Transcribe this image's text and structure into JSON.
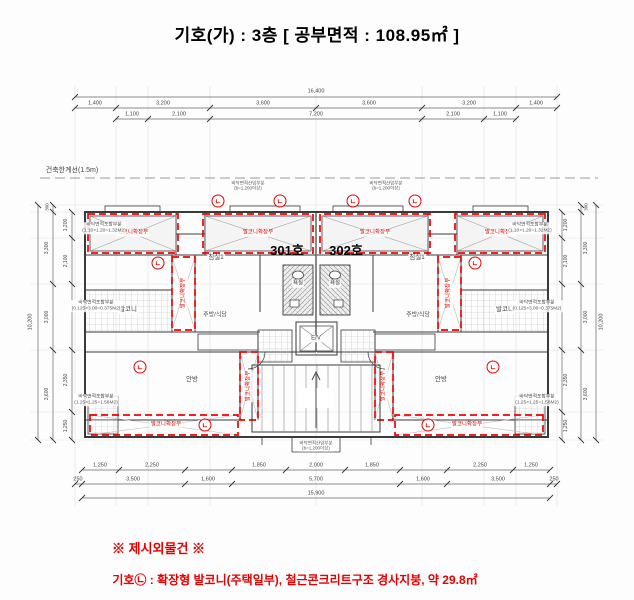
{
  "title": "기호(가) : 3층 [ 공부면적 : 108.95㎡ ]",
  "footer": {
    "heading": "※ 제시외물건 ※",
    "note": "기호㉡ : 확장형 발코니(주택일부), 철근콘크리트구조 경사지붕, 약 29.8㎡"
  },
  "colors": {
    "red": "#e60000",
    "wall": "#3a3a3a",
    "dim": "#444444",
    "grid": "#d4d4d4"
  },
  "plan": {
    "setback_label": "건축한계선(1.5m)",
    "mark_char": "ㄴ",
    "marks": [
      {
        "x": 218,
        "y": 201
      },
      {
        "x": 280,
        "y": 201
      },
      {
        "x": 353,
        "y": 201
      },
      {
        "x": 415,
        "y": 201
      },
      {
        "x": 158,
        "y": 263
      },
      {
        "x": 475,
        "y": 263
      },
      {
        "x": 140,
        "y": 367
      },
      {
        "x": 493,
        "y": 367
      },
      {
        "x": 205,
        "y": 425
      },
      {
        "x": 428,
        "y": 425
      }
    ],
    "texts": [
      {
        "n": "setback-line-label",
        "t": "건축한계선(1.5m)",
        "x": 72,
        "y": 171,
        "s": 7,
        "c": "#444"
      },
      {
        "n": "unit-301-label",
        "t": "301호",
        "x": 287,
        "y": 251,
        "s": 13,
        "b": 1,
        "c": "#000"
      },
      {
        "n": "unit-302-label",
        "t": "302호",
        "x": 346,
        "y": 251,
        "s": 13,
        "b": 1,
        "c": "#000"
      },
      {
        "n": "room-bedroom1-301",
        "t": "침실1",
        "x": 216,
        "y": 258,
        "s": 6.5,
        "bg": 1
      },
      {
        "n": "room-bedroom1-302",
        "t": "침실1",
        "x": 417,
        "y": 258,
        "s": 6.5,
        "bg": 1
      },
      {
        "n": "room-balcony-301",
        "t": "발코니",
        "x": 128,
        "y": 310,
        "s": 6.5,
        "bg": 1
      },
      {
        "n": "room-balcony-302",
        "t": "발코니",
        "x": 505,
        "y": 310,
        "s": 6.5,
        "bg": 1
      },
      {
        "n": "room-kitchen-301",
        "t": "주방/식당",
        "x": 215,
        "y": 316,
        "s": 6,
        "bg": 1
      },
      {
        "n": "room-kitchen-302",
        "t": "주방/식당",
        "x": 418,
        "y": 316,
        "s": 6,
        "bg": 1
      },
      {
        "n": "room-master-301",
        "t": "안방",
        "x": 192,
        "y": 380,
        "s": 6.5,
        "bg": 1
      },
      {
        "n": "room-master-302",
        "t": "안방",
        "x": 441,
        "y": 380,
        "s": 6.5,
        "bg": 1
      },
      {
        "n": "room-bath-301",
        "t": "욕실",
        "x": 298,
        "y": 284,
        "s": 5.5,
        "bg": 1
      },
      {
        "n": "room-bath-302",
        "t": "욕실",
        "x": 335,
        "y": 284,
        "s": 5.5,
        "bg": 1
      },
      {
        "n": "elevator-label",
        "t": "E/V",
        "x": 316,
        "y": 339,
        "s": 6,
        "bg": 1
      },
      {
        "n": "balcony-ext-label",
        "t": "발코니확장부",
        "x": 133,
        "y": 233,
        "s": 5.5,
        "c": "#e60000",
        "bg": 1
      },
      {
        "n": "balcony-ext-label",
        "t": "발코니확장부",
        "x": 258,
        "y": 233,
        "s": 5.5,
        "c": "#e60000",
        "bg": 1
      },
      {
        "n": "balcony-ext-label",
        "t": "발코니확장부",
        "x": 375,
        "y": 233,
        "s": 5.5,
        "c": "#e60000",
        "bg": 1
      },
      {
        "n": "balcony-ext-label",
        "t": "발코니확장부",
        "x": 500,
        "y": 233,
        "s": 5.5,
        "c": "#e60000",
        "bg": 1
      },
      {
        "n": "balcony-ext-label",
        "t": "발코니확장부",
        "x": 184,
        "y": 293,
        "s": 5.5,
        "c": "#e60000",
        "r": -90,
        "bg": 1
      },
      {
        "n": "balcony-ext-label",
        "t": "발코니확장부",
        "x": 449,
        "y": 293,
        "s": 5.5,
        "c": "#e60000",
        "r": -90,
        "bg": 1
      },
      {
        "n": "balcony-ext-label",
        "t": "발코니확장부",
        "x": 249,
        "y": 386,
        "s": 5.5,
        "c": "#e60000",
        "r": -90,
        "bg": 1
      },
      {
        "n": "balcony-ext-label",
        "t": "발코니확장부",
        "x": 384,
        "y": 386,
        "s": 5.5,
        "c": "#e60000",
        "r": -90,
        "bg": 1
      },
      {
        "n": "balcony-ext-label",
        "t": "발코니확장부",
        "x": 166,
        "y": 425,
        "s": 5.5,
        "c": "#e60000",
        "bg": 1
      },
      {
        "n": "balcony-ext-label",
        "t": "발코니확장부",
        "x": 467,
        "y": 425,
        "s": 5.5,
        "c": "#e60000",
        "bg": 1
      },
      {
        "n": "area-note",
        "t": [
          "바닥면적포함부분",
          "(1.10×1.20=1.32M2)"
        ],
        "x": 104,
        "y": 228,
        "s": 4.8,
        "c": "#555",
        "bg": 1
      },
      {
        "n": "area-note",
        "t": [
          "바닥면적포함부분",
          "(1.10×1.20=1.32M2)"
        ],
        "x": 530,
        "y": 228,
        "s": 4.8,
        "c": "#555",
        "bg": 1
      },
      {
        "n": "area-note",
        "t": [
          "바닥면적포함부분",
          "(0.125×3.00=0.375M2)"
        ],
        "x": 96,
        "y": 306,
        "s": 4.8,
        "c": "#555",
        "bg": 1
      },
      {
        "n": "area-note",
        "t": [
          "바닥면적포함부분",
          "(0.125×3.00=0.375M2)"
        ],
        "x": 537,
        "y": 306,
        "s": 4.8,
        "c": "#555",
        "bg": 1
      },
      {
        "n": "area-note",
        "t": [
          "바닥면적포함부분",
          "(1.25×1.25=1.56M2)"
        ],
        "x": 96,
        "y": 400,
        "s": 4.8,
        "c": "#555",
        "bg": 1
      },
      {
        "n": "area-note",
        "t": [
          "바닥면적포함부분",
          "(1.25×1.25=1.56M2)"
        ],
        "x": 537,
        "y": 400,
        "s": 4.8,
        "c": "#555",
        "bg": 1
      },
      {
        "n": "area-note",
        "t": [
          "바닥면적산입부분",
          "(b=1,200이상)"
        ],
        "x": 248,
        "y": 186,
        "s": 4.5,
        "c": "#555"
      },
      {
        "n": "area-note",
        "t": [
          "바닥면적산입부분",
          "(b=1,200이상)"
        ],
        "x": 386,
        "y": 186,
        "s": 4.5,
        "c": "#555"
      },
      {
        "n": "area-note",
        "t": [
          "바닥면적산입부분",
          "(b=1,200이상)"
        ],
        "x": 316,
        "y": 446,
        "s": 4.5,
        "c": "#555",
        "bg": 1
      },
      {
        "n": "dim-label",
        "t": "16,400",
        "x": 316,
        "y": 92,
        "s": 5.5
      },
      {
        "n": "dim-label",
        "t": "1,400",
        "x": 95,
        "y": 104,
        "s": 5.5
      },
      {
        "n": "dim-label",
        "t": "3,200",
        "x": 163,
        "y": 104,
        "s": 5.5
      },
      {
        "n": "dim-label",
        "t": "3,600",
        "x": 263,
        "y": 104,
        "s": 5.5
      },
      {
        "n": "dim-label",
        "t": "3,600",
        "x": 369,
        "y": 104,
        "s": 5.5
      },
      {
        "n": "dim-label",
        "t": "3,200",
        "x": 469,
        "y": 104,
        "s": 5.5
      },
      {
        "n": "dim-label",
        "t": "1,400",
        "x": 536,
        "y": 104,
        "s": 5.5
      },
      {
        "n": "dim-label",
        "t": "1,100",
        "x": 132,
        "y": 115,
        "s": 5.5
      },
      {
        "n": "dim-label",
        "t": "2,100",
        "x": 179,
        "y": 115,
        "s": 5.5
      },
      {
        "n": "dim-label",
        "t": "7,200",
        "x": 316,
        "y": 115,
        "s": 5.5
      },
      {
        "n": "dim-label",
        "t": "2,100",
        "x": 453,
        "y": 115,
        "s": 5.5
      },
      {
        "n": "dim-label",
        "t": "1,100",
        "x": 500,
        "y": 115,
        "s": 5.5
      },
      {
        "n": "dim-label",
        "t": "1,250",
        "x": 100,
        "y": 466,
        "s": 5.5
      },
      {
        "n": "dim-label",
        "t": "2,250",
        "x": 152,
        "y": 466,
        "s": 5.5
      },
      {
        "n": "dim-label",
        "t": "1,850",
        "x": 259,
        "y": 466,
        "s": 5.5
      },
      {
        "n": "dim-label",
        "t": "2,000",
        "x": 316,
        "y": 466,
        "s": 5.5
      },
      {
        "n": "dim-label",
        "t": "1,850",
        "x": 372,
        "y": 466,
        "s": 5.5
      },
      {
        "n": "dim-label",
        "t": "2,250",
        "x": 480,
        "y": 466,
        "s": 5.5
      },
      {
        "n": "dim-label",
        "t": "1,250",
        "x": 531,
        "y": 466,
        "s": 5.5
      },
      {
        "n": "dim-label",
        "t": "250",
        "x": 78,
        "y": 480,
        "s": 5.5
      },
      {
        "n": "dim-label",
        "t": "3,500",
        "x": 133,
        "y": 480,
        "s": 5.5
      },
      {
        "n": "dim-label",
        "t": "1,600",
        "x": 208,
        "y": 480,
        "s": 5.5
      },
      {
        "n": "dim-label",
        "t": "5,700",
        "x": 316,
        "y": 480,
        "s": 5.5
      },
      {
        "n": "dim-label",
        "t": "1,600",
        "x": 423,
        "y": 480,
        "s": 5.5
      },
      {
        "n": "dim-label",
        "t": "3,500",
        "x": 498,
        "y": 480,
        "s": 5.5
      },
      {
        "n": "dim-label",
        "t": "250",
        "x": 554,
        "y": 480,
        "s": 5.5
      },
      {
        "n": "dim-label",
        "t": "15,900",
        "x": 316,
        "y": 494,
        "s": 5.5
      },
      {
        "n": "dim-label",
        "t": "10,200",
        "x": 31,
        "y": 322,
        "s": 5.5,
        "r": -90
      },
      {
        "n": "dim-label",
        "t": "300",
        "x": 47,
        "y": 207,
        "s": 4.5,
        "r": -90
      },
      {
        "n": "dim-label",
        "t": "3,300",
        "x": 47,
        "y": 248,
        "s": 5,
        "r": -90
      },
      {
        "n": "dim-label",
        "t": "3,000",
        "x": 47,
        "y": 317,
        "s": 5,
        "r": -90
      },
      {
        "n": "dim-label",
        "t": "3,600",
        "x": 47,
        "y": 394,
        "s": 5,
        "r": -90
      },
      {
        "n": "dim-label",
        "t": "1,200",
        "x": 66,
        "y": 225,
        "s": 5,
        "r": -90
      },
      {
        "n": "dim-label",
        "t": "2,100",
        "x": 66,
        "y": 261,
        "s": 5,
        "r": -90
      },
      {
        "n": "dim-label",
        "t": "2,350",
        "x": 66,
        "y": 380,
        "s": 5,
        "r": -90
      },
      {
        "n": "dim-label",
        "t": "1,250",
        "x": 66,
        "y": 426,
        "s": 5,
        "r": -90
      },
      {
        "n": "dim-label",
        "t": "10,200",
        "x": 602,
        "y": 322,
        "s": 5.5,
        "r": -90
      },
      {
        "n": "dim-label",
        "t": "300",
        "x": 586,
        "y": 207,
        "s": 4.5,
        "r": -90
      },
      {
        "n": "dim-label",
        "t": "3,300",
        "x": 586,
        "y": 248,
        "s": 5,
        "r": -90
      },
      {
        "n": "dim-label",
        "t": "3,000",
        "x": 586,
        "y": 317,
        "s": 5,
        "r": -90
      },
      {
        "n": "dim-label",
        "t": "3,600",
        "x": 586,
        "y": 394,
        "s": 5,
        "r": -90
      },
      {
        "n": "dim-label",
        "t": "1,200",
        "x": 566,
        "y": 225,
        "s": 5,
        "r": -90
      },
      {
        "n": "dim-label",
        "t": "2,100",
        "x": 566,
        "y": 261,
        "s": 5,
        "r": -90
      },
      {
        "n": "dim-label",
        "t": "2,350",
        "x": 566,
        "y": 380,
        "s": 5,
        "r": -90
      },
      {
        "n": "dim-label",
        "t": "1,250",
        "x": 566,
        "y": 426,
        "s": 5,
        "r": -90
      }
    ]
  }
}
